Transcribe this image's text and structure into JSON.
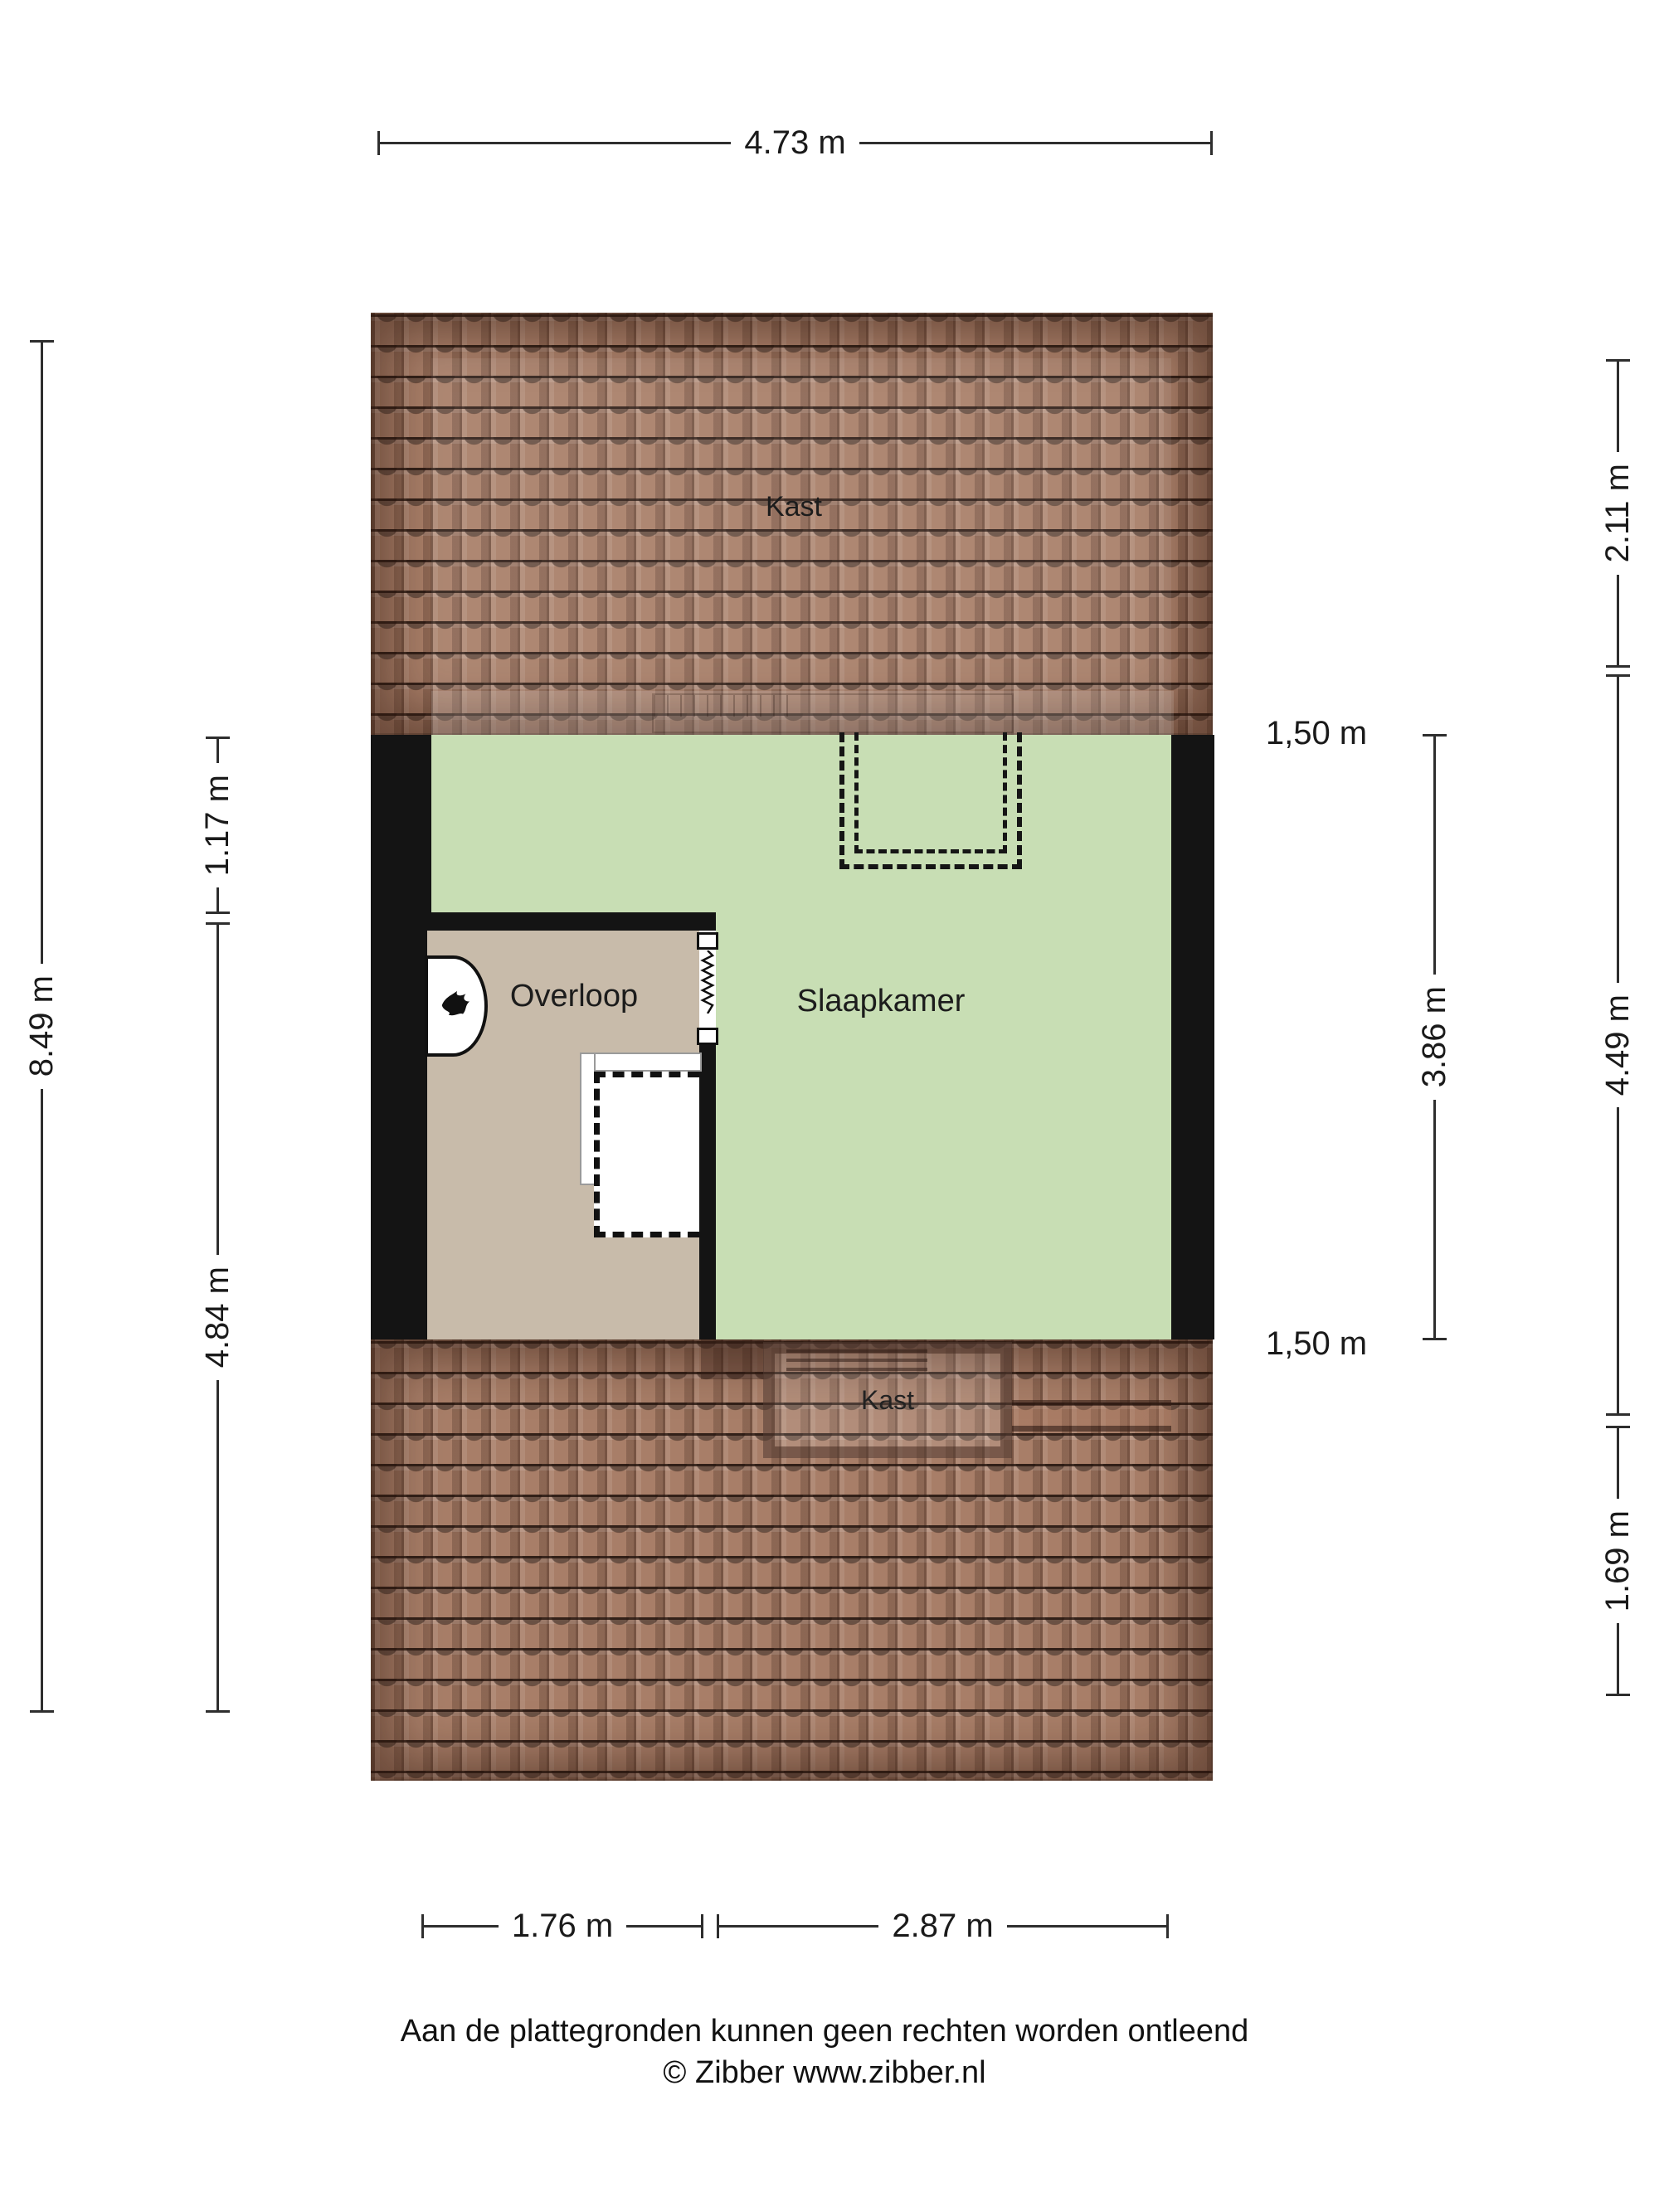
{
  "rooms": {
    "kast_top": "Kast",
    "overloop": "Overloop",
    "slaapkamer": "Slaapkamer",
    "kast_bottom": "Kast"
  },
  "dimensions": {
    "top": "4.73 m",
    "left_total": "8.49 m",
    "left_upper": "1.17 m",
    "left_lower": "4.84 m",
    "right_upper": "2.11 m",
    "right_middle": "4.49 m",
    "right_lower": "1.69 m",
    "right_inner": "3.86 m",
    "height_line_top": "1,50 m",
    "height_line_bottom": "1,50 m",
    "bottom_left": "1.76 m",
    "bottom_right": "2.87 m"
  },
  "footer": {
    "disclaimer": "Aan de plattegronden kunnen geen rechten worden ontleend",
    "credit": "© Zibber www.zibber.nl"
  },
  "colors": {
    "room_green": "#c8deb4",
    "hall_beige": "#c8bbaa",
    "roof_brown": "#a87e68",
    "wall_black": "#141414",
    "dimension_line": "#2e2e2e"
  }
}
